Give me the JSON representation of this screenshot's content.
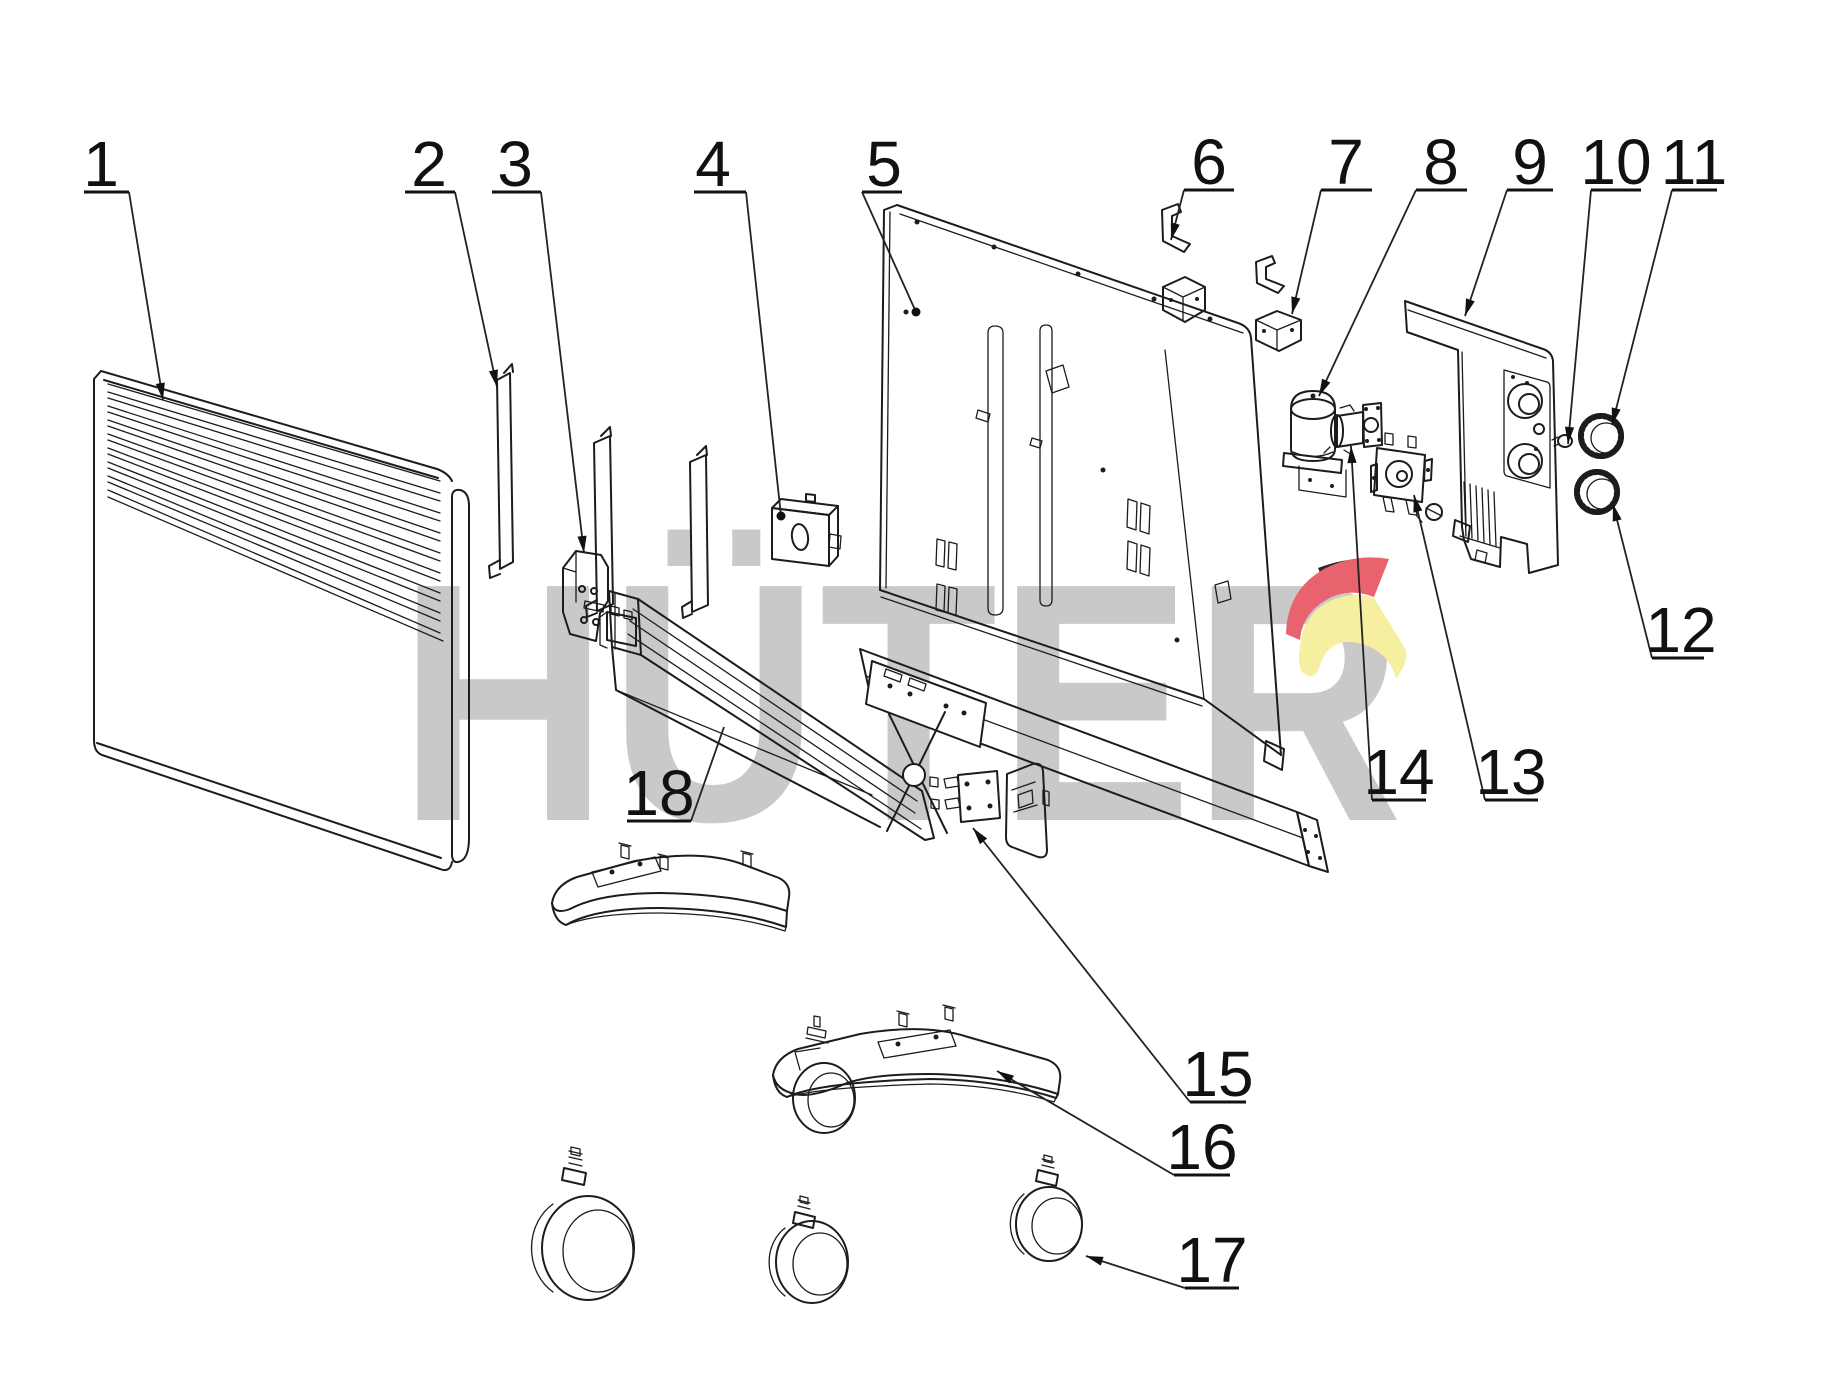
{
  "watermark": {
    "text": "HÜTER",
    "text_color": "#c9c9c9",
    "logo_red": "#e8636e",
    "logo_yellow": "#f6efa0",
    "logo_dark": "#2a2a2a"
  },
  "style": {
    "background": "#ffffff",
    "line_color": "#1c1c1c",
    "label_color": "#111111"
  },
  "callouts": [
    {
      "label": "1",
      "x": 101,
      "y": 186,
      "underline": [
        84,
        129,
        192
      ],
      "leader": [
        [
          129,
          192
        ],
        [
          163,
          400
        ]
      ],
      "end": "arrow"
    },
    {
      "label": "2",
      "x": 429,
      "y": 186,
      "underline": [
        405,
        455,
        192
      ],
      "leader": [
        [
          455,
          192
        ],
        [
          497,
          387
        ]
      ],
      "end": "arrow"
    },
    {
      "label": "3",
      "x": 515,
      "y": 186,
      "underline": [
        492,
        541,
        192
      ],
      "leader": [
        [
          541,
          192
        ],
        [
          584,
          553
        ]
      ],
      "end": "arrow"
    },
    {
      "label": "4",
      "x": 713,
      "y": 186,
      "underline": [
        694,
        746,
        192
      ],
      "leader": [
        [
          746,
          192
        ],
        [
          781,
          516
        ]
      ],
      "end": "dot"
    },
    {
      "label": "5",
      "x": 884,
      "y": 186,
      "underline": [
        862,
        902,
        192
      ],
      "leader": [
        [
          862,
          192
        ],
        [
          916,
          312
        ]
      ],
      "end": "dot"
    },
    {
      "label": "6",
      "x": 1209,
      "y": 184,
      "underline": [
        1184,
        1234,
        190
      ],
      "leader": [
        [
          1184,
          190
        ],
        [
          1171,
          240
        ]
      ],
      "end": "arrow"
    },
    {
      "label": "7",
      "x": 1346,
      "y": 184,
      "underline": [
        1321,
        1372,
        190
      ],
      "leader": [
        [
          1321,
          190
        ],
        [
          1292,
          314
        ]
      ],
      "end": "arrow"
    },
    {
      "label": "8",
      "x": 1441,
      "y": 184,
      "underline": [
        1416,
        1467,
        190
      ],
      "leader": [
        [
          1416,
          190
        ],
        [
          1319,
          396
        ]
      ],
      "end": "arrow"
    },
    {
      "label": "9",
      "x": 1530,
      "y": 184,
      "underline": [
        1507,
        1553,
        190
      ],
      "leader": [
        [
          1507,
          190
        ],
        [
          1465,
          316
        ]
      ],
      "end": "arrow"
    },
    {
      "label": "10",
      "x": 1616,
      "y": 184,
      "underline": [
        1591,
        1641,
        190
      ],
      "leader": [
        [
          1591,
          190
        ],
        [
          1568,
          444
        ]
      ],
      "end": "arrow"
    },
    {
      "label": "11",
      "x": 1694,
      "y": 184,
      "underline": [
        1672,
        1717,
        190
      ],
      "leader": [
        [
          1672,
          190
        ],
        [
          1612,
          425
        ]
      ],
      "end": "arrow"
    },
    {
      "label": "12",
      "x": 1681,
      "y": 652,
      "underline": [
        1652,
        1704,
        658
      ],
      "leader": [
        [
          1652,
          658
        ],
        [
          1613,
          504
        ]
      ],
      "end": "arrow"
    },
    {
      "label": "13",
      "x": 1511,
      "y": 794,
      "underline": [
        1485,
        1538,
        800
      ],
      "leader": [
        [
          1485,
          800
        ],
        [
          1414,
          495
        ]
      ],
      "end": "arrow"
    },
    {
      "label": "14",
      "x": 1399,
      "y": 794,
      "underline": [
        1372,
        1426,
        800
      ],
      "leader": [
        [
          1372,
          800
        ],
        [
          1351,
          446
        ]
      ],
      "end": "arrow"
    },
    {
      "label": "15",
      "x": 1218,
      "y": 1096,
      "underline": [
        1190,
        1246,
        1102
      ],
      "leader": [
        [
          1190,
          1102
        ],
        [
          973,
          828
        ]
      ],
      "end": "arrow"
    },
    {
      "label": "16",
      "x": 1202,
      "y": 1169,
      "underline": [
        1174,
        1230,
        1175
      ],
      "leader": [
        [
          1174,
          1175
        ],
        [
          997,
          1071
        ]
      ],
      "end": "arrow"
    },
    {
      "label": "17",
      "x": 1212,
      "y": 1282,
      "underline": [
        1185,
        1239,
        1288
      ],
      "leader": [
        [
          1185,
          1288
        ],
        [
          1086,
          1256
        ]
      ],
      "end": "arrow"
    },
    {
      "label": "18",
      "x": 659,
      "y": 815,
      "underline": [
        627,
        691,
        821
      ],
      "leader": [
        [
          691,
          821
        ],
        [
          724,
          727
        ]
      ],
      "end": "none"
    }
  ]
}
